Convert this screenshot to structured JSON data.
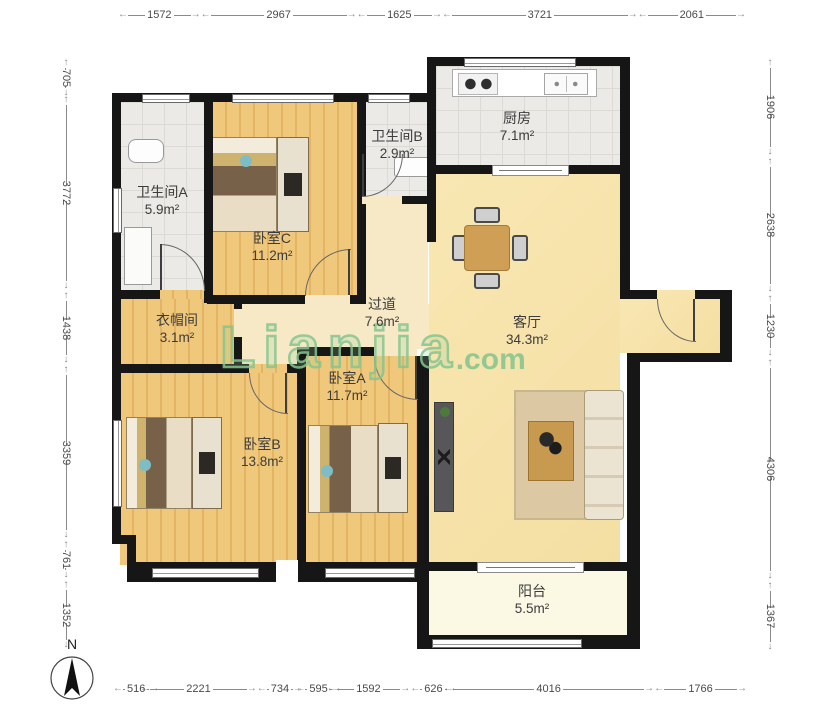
{
  "compass": {
    "label": "N"
  },
  "watermark": {
    "brand": "Lianjia",
    "suffix": ".com"
  },
  "dimensions": {
    "top": [
      1572,
      2967,
      1625,
      3721,
      2061
    ],
    "bottom": [
      516,
      2221,
      734,
      595,
      1592,
      626,
      4016,
      1766
    ],
    "left": [
      705,
      3772,
      1438,
      3359,
      761,
      1352
    ],
    "right": [
      1906,
      2638,
      1230,
      4306,
      1367
    ]
  },
  "rooms": [
    {
      "id": "bathroom-a",
      "name": "卫生间A",
      "area": "5.9m²"
    },
    {
      "id": "bedroom-c",
      "name": "卧室C",
      "area": "11.2m²"
    },
    {
      "id": "bathroom-b",
      "name": "卫生间B",
      "area": "2.9m²"
    },
    {
      "id": "kitchen",
      "name": "厨房",
      "area": "7.1m²"
    },
    {
      "id": "hallway",
      "name": "过道",
      "area": "7.6m²"
    },
    {
      "id": "living-room",
      "name": "客厅",
      "area": "34.3m²"
    },
    {
      "id": "cloakroom",
      "name": "衣帽间",
      "area": "3.1m²"
    },
    {
      "id": "bedroom-a",
      "name": "卧室A",
      "area": "11.7m²"
    },
    {
      "id": "bedroom-b",
      "name": "卧室B",
      "area": "13.8m²"
    },
    {
      "id": "balcony",
      "name": "阳台",
      "area": "5.5m²"
    }
  ],
  "colors": {
    "wall": "#161616",
    "wood_floor": "#f0c87b",
    "living_floor": "#f8e5ad",
    "tile_floor": "#ebeae6",
    "balcony_floor": "#fbf8e4",
    "watermark_green": "#86c48e",
    "dimension_text": "#4a4a4a"
  }
}
